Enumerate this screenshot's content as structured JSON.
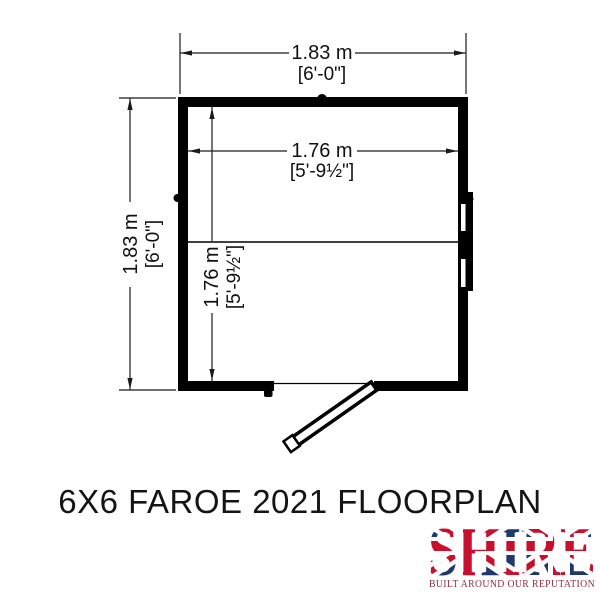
{
  "title": "6X6 FAROE 2021 FLOORPLAN",
  "dimensions": {
    "overall_width": {
      "metric": "1.83 m",
      "imperial": "[6'-0\"]"
    },
    "overall_depth": {
      "metric": "1.83 m",
      "imperial": "[6'-0\"]"
    },
    "internal_width": {
      "metric": "1.76 m",
      "imperial": "[5'-9½\"]"
    },
    "internal_depth": {
      "metric": "1.76 m",
      "imperial": "[5'-9½\"]"
    }
  },
  "logo": {
    "name": "SHIRE",
    "tagline": "BUILT AROUND OUR REPUTATION"
  },
  "colors": {
    "line": "#000000",
    "dim_text": "#111111",
    "flag_blue": "#20386b",
    "flag_red": "#c8102e",
    "tagline_red": "#8b2e3e"
  }
}
